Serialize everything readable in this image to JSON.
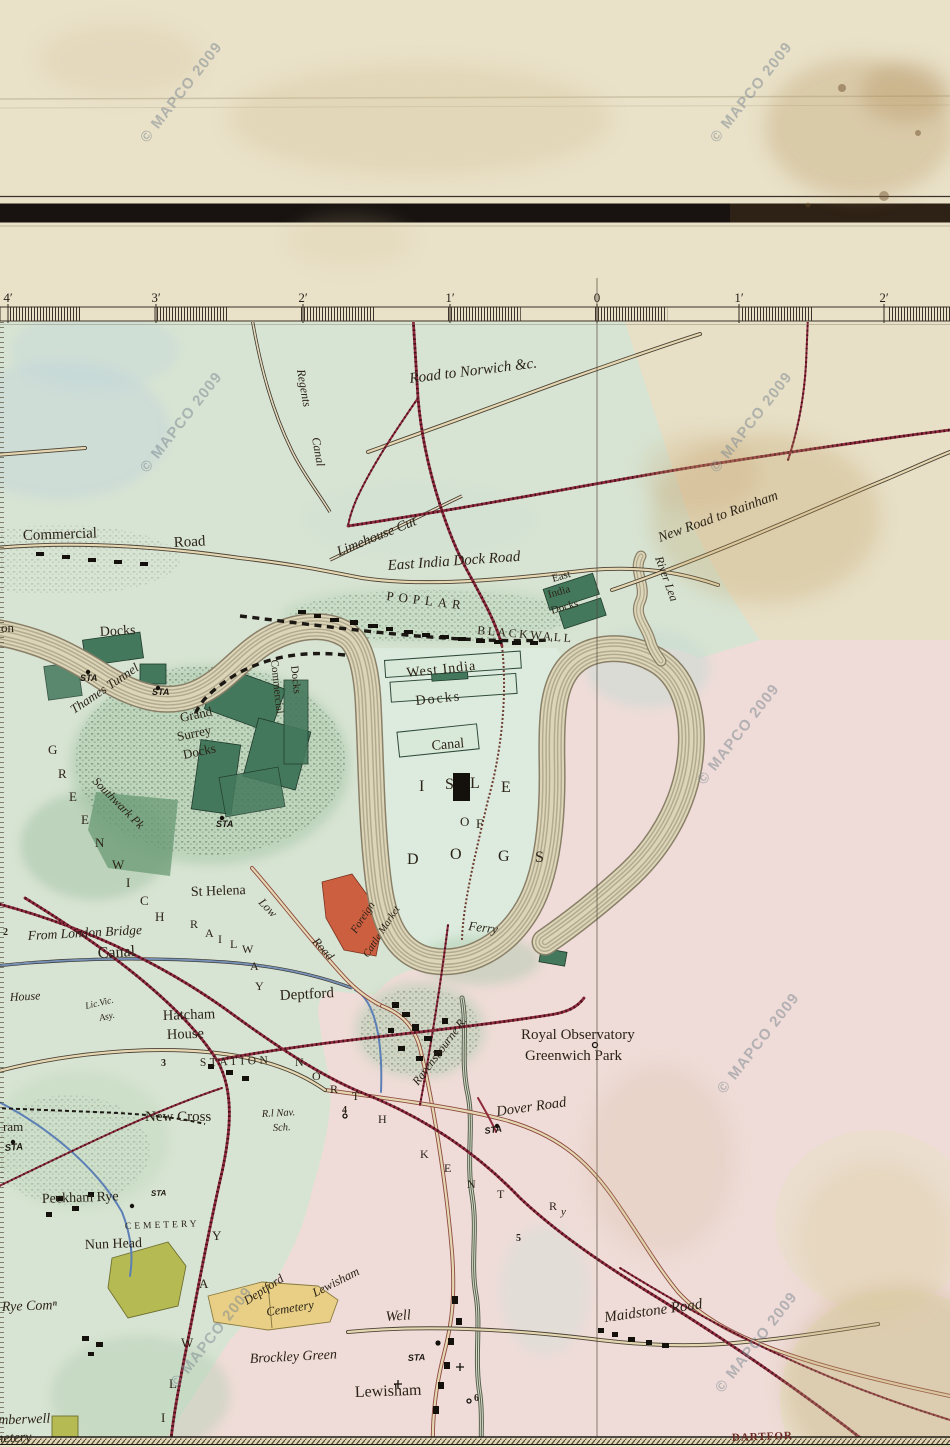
{
  "watermark": {
    "text": "© MAPCO 2009",
    "rotation": -52,
    "positions": [
      [
        185,
        95
      ],
      [
        755,
        95
      ],
      [
        185,
        425
      ],
      [
        755,
        425
      ],
      [
        742,
        737
      ],
      [
        762,
        1046
      ],
      [
        215,
        1340
      ],
      [
        760,
        1345
      ]
    ]
  },
  "scale_bar": {
    "unit_note": "miles",
    "ticks": [
      [
        "4′",
        8
      ],
      [
        "3′",
        156
      ],
      [
        "2′",
        303
      ],
      [
        "1′",
        450
      ],
      [
        "0",
        597
      ],
      [
        "1′",
        739
      ],
      [
        "2′",
        884
      ]
    ],
    "y_label": 302,
    "bar_top": 307,
    "bar_bottom": 321,
    "x_start": 8,
    "x_end": 950,
    "seg_px": 73.25
  },
  "meridian_x": 597,
  "colors": {
    "paper": "#e9e1c8",
    "map_green": "#d7e4d4",
    "map_pink": "#f0dcda",
    "map_cream": "#e7dfc6",
    "dock_green": "#44785c",
    "railway_red": "#8f2b3c",
    "road_tan": "#e4d7b2",
    "canal_blue": "#5c7fb5",
    "cemetery_yellow": "#e8cf85",
    "cemetery_green": "#b6ba52",
    "market_red": "#cd5f41",
    "ink": "#2b2317",
    "watermark_grey": "#7e8992",
    "river_band": "#b3ab90",
    "river_fill": "#ddd5b8",
    "border_black": "#181310"
  },
  "map": {
    "labels": [
      {
        "id": "road-to-norwich",
        "t": "Road to Norwich &c.",
        "x": 410,
        "y": 383,
        "r": -7,
        "s": 15,
        "c": "i"
      },
      {
        "id": "regents",
        "t": "Regents",
        "x": 297,
        "y": 370,
        "r": 80,
        "s": 12,
        "c": "i"
      },
      {
        "id": "regents-canal",
        "t": "Canal",
        "x": 312,
        "y": 438,
        "r": 80,
        "s": 12,
        "c": "i"
      },
      {
        "id": "commercial",
        "t": "Commercial",
        "x": 23,
        "y": 540,
        "r": -2,
        "s": 15
      },
      {
        "id": "commercial-road",
        "t": "Road",
        "x": 174,
        "y": 547,
        "r": -3,
        "s": 15
      },
      {
        "id": "limehouse-cut",
        "t": "Limehouse Cut",
        "x": 339,
        "y": 556,
        "r": -22,
        "s": 14,
        "c": "i"
      },
      {
        "id": "east-india-dock-road",
        "t": "East India Dock Road",
        "x": 388,
        "y": 570,
        "r": -4,
        "s": 15,
        "c": "i"
      },
      {
        "id": "poplar",
        "t": "POPLAR",
        "x": 386,
        "y": 600,
        "r": 7,
        "s": 13,
        "ls": 5
      },
      {
        "id": "blackwall",
        "t": "BLACKWALL",
        "x": 477,
        "y": 634,
        "r": 5,
        "s": 12,
        "ls": 2.5
      },
      {
        "id": "east-india-1",
        "t": "East",
        "x": 553,
        "y": 582,
        "r": -16,
        "s": 11
      },
      {
        "id": "east-india-2",
        "t": "India",
        "x": 549,
        "y": 598,
        "r": -16,
        "s": 11
      },
      {
        "id": "east-india-3",
        "t": "Docks",
        "x": 552,
        "y": 614,
        "r": -16,
        "s": 11
      },
      {
        "id": "new-road-rainham",
        "t": "New Road to Rainham",
        "x": 660,
        "y": 542,
        "r": -20,
        "s": 14,
        "c": "i"
      },
      {
        "id": "river-lea",
        "t": "River Lea",
        "x": 655,
        "y": 558,
        "r": 70,
        "s": 12,
        "c": "i"
      },
      {
        "id": "london-on",
        "t": "on",
        "x": 1,
        "y": 632,
        "s": 13
      },
      {
        "id": "london-docks",
        "t": "Docks",
        "x": 100,
        "y": 636,
        "r": -3,
        "s": 14
      },
      {
        "id": "thames-tunnel",
        "t": "Thames Tunnel",
        "x": 74,
        "y": 714,
        "r": -34,
        "s": 13,
        "c": "i"
      },
      {
        "id": "sta-1",
        "t": "STA",
        "x": 80,
        "y": 681,
        "s": 9,
        "c": "b"
      },
      {
        "id": "sta-2",
        "t": "STA",
        "x": 152,
        "y": 695,
        "s": 9,
        "c": "b"
      },
      {
        "id": "sta-3",
        "t": "STA",
        "x": 216,
        "y": 827,
        "s": 9,
        "c": "b"
      },
      {
        "id": "grand",
        "t": "Grand",
        "x": 181,
        "y": 722,
        "r": -12,
        "s": 13
      },
      {
        "id": "surrey",
        "t": "Surrey",
        "x": 178,
        "y": 741,
        "r": -12,
        "s": 13
      },
      {
        "id": "grand-surrey-docks",
        "t": "Docks",
        "x": 184,
        "y": 759,
        "r": -12,
        "s": 13
      },
      {
        "id": "commercial-docks-1",
        "t": "Commercial",
        "x": 271,
        "y": 660,
        "r": 84,
        "s": 11
      },
      {
        "id": "commercial-docks-2",
        "t": "Docks",
        "x": 291,
        "y": 666,
        "r": 84,
        "s": 11
      },
      {
        "id": "southwark-pk",
        "t": "Southwark Pk",
        "x": 92,
        "y": 782,
        "r": 45,
        "s": 12,
        "c": "i"
      },
      {
        "id": "west-india",
        "t": "West India",
        "x": 407,
        "y": 677,
        "r": -6,
        "s": 14,
        "ls": 1
      },
      {
        "id": "west-india-docks",
        "t": "Docks",
        "x": 416,
        "y": 705,
        "r": -6,
        "s": 14,
        "ls": 2
      },
      {
        "id": "millwall-canal",
        "t": "Canal",
        "x": 432,
        "y": 750,
        "r": -5,
        "s": 14
      },
      {
        "id": "isle-i",
        "t": "I",
        "x": 419,
        "y": 791,
        "s": 16
      },
      {
        "id": "isle-s",
        "t": "S",
        "x": 445,
        "y": 789,
        "s": 16
      },
      {
        "id": "isle-l",
        "t": "L",
        "x": 470,
        "y": 788,
        "s": 16
      },
      {
        "id": "isle-e",
        "t": "E",
        "x": 501,
        "y": 792,
        "s": 16
      },
      {
        "id": "isle-o2",
        "t": "O",
        "x": 460,
        "y": 826,
        "s": 13
      },
      {
        "id": "isle-f",
        "t": "F",
        "x": 476,
        "y": 828,
        "s": 13
      },
      {
        "id": "dogs-d",
        "t": "D",
        "x": 407,
        "y": 864,
        "s": 16
      },
      {
        "id": "dogs-o",
        "t": "O",
        "x": 450,
        "y": 859,
        "s": 16
      },
      {
        "id": "dogs-g",
        "t": "G",
        "x": 498,
        "y": 861,
        "s": 16
      },
      {
        "id": "dogs-s",
        "t": "S",
        "x": 535,
        "y": 862,
        "s": 16
      },
      {
        "id": "ferry",
        "t": "Ferry",
        "x": 468,
        "y": 930,
        "r": 7,
        "s": 13,
        "c": "i"
      },
      {
        "id": "foreign",
        "t": "Foreign",
        "x": 356,
        "y": 934,
        "r": -57,
        "s": 11,
        "c": "i"
      },
      {
        "id": "cattle-market",
        "t": "Cattle Market",
        "x": 368,
        "y": 958,
        "r": -57,
        "s": 10.5,
        "c": "i"
      },
      {
        "id": "st-helena",
        "t": "St Helena",
        "x": 191,
        "y": 896,
        "r": -2,
        "s": 14
      },
      {
        "id": "low",
        "t": "Low",
        "x": 258,
        "y": 903,
        "r": 46,
        "s": 12,
        "c": "i"
      },
      {
        "id": "low-road",
        "t": "Road",
        "x": 312,
        "y": 942,
        "r": 48,
        "s": 12,
        "c": "i"
      },
      {
        "id": "from-london-bridge",
        "t": "From London Bridge",
        "x": 28,
        "y": 940,
        "r": -3,
        "s": 13.5,
        "c": "i"
      },
      {
        "id": "surrey-canal",
        "t": "Canal",
        "x": 98,
        "y": 958,
        "r": -3,
        "s": 16
      },
      {
        "id": "mile-2",
        "t": "2",
        "x": 3,
        "y": 935,
        "s": 10,
        "c": "n"
      },
      {
        "id": "house-w",
        "t": "House",
        "x": 10,
        "y": 1001,
        "r": -3,
        "s": 12,
        "c": "i"
      },
      {
        "id": "lic-vic",
        "t": "Lic.Vic.",
        "x": 86,
        "y": 1009,
        "r": -13,
        "s": 9.5,
        "c": "i"
      },
      {
        "id": "asy",
        "t": "Asy.",
        "x": 100,
        "y": 1021,
        "r": -13,
        "s": 9.5,
        "c": "i"
      },
      {
        "id": "hatcham",
        "t": "Hatcham",
        "x": 163,
        "y": 1020,
        "r": -2,
        "s": 14.5
      },
      {
        "id": "hatcham-house",
        "t": "House",
        "x": 167,
        "y": 1039,
        "r": -2,
        "s": 14.5
      },
      {
        "id": "mile-3",
        "t": "3",
        "x": 161,
        "y": 1066,
        "s": 10,
        "c": "n"
      },
      {
        "id": "station",
        "t": "STATION",
        "x": 200,
        "y": 1066,
        "r": -2,
        "s": 11.5,
        "ls": 3.5
      },
      {
        "id": "deptford",
        "t": "Deptford",
        "x": 280,
        "y": 1000,
        "r": -3,
        "s": 15
      },
      {
        "id": "new-cross",
        "t": "New Cross",
        "x": 145,
        "y": 1121,
        "s": 15
      },
      {
        "id": "r-nav",
        "t": "R.l Nav.",
        "x": 262,
        "y": 1117,
        "r": -3,
        "s": 10.5,
        "c": "i"
      },
      {
        "id": "sch",
        "t": "Sch.",
        "x": 273,
        "y": 1131,
        "r": -3,
        "s": 10.5,
        "c": "i"
      },
      {
        "id": "mile-4",
        "t": "4",
        "x": 342,
        "y": 1113,
        "s": 10,
        "c": "n"
      },
      {
        "id": "dover-road",
        "t": "Dover Road",
        "x": 497,
        "y": 1116,
        "r": -8,
        "s": 14.5,
        "c": "i"
      },
      {
        "id": "sta-dover",
        "t": "STA",
        "x": 485,
        "y": 1134,
        "r": -8,
        "s": 9,
        "c": "b"
      },
      {
        "id": "royal-observatory",
        "t": "Royal Observatory",
        "x": 521,
        "y": 1039,
        "s": 15
      },
      {
        "id": "greenwich-park",
        "t": "Greenwich Park",
        "x": 525,
        "y": 1060,
        "s": 15
      },
      {
        "id": "ravensbourne",
        "t": "Ravensbourne R.",
        "x": 418,
        "y": 1086,
        "r": -53,
        "s": 12,
        "c": "i"
      },
      {
        "id": "peckham-rye",
        "t": "Peckham Rye",
        "x": 42,
        "y": 1203,
        "r": -2,
        "s": 14
      },
      {
        "id": "sta-peckham",
        "t": "STA",
        "x": 151,
        "y": 1196,
        "r": -2,
        "s": 8,
        "c": "b"
      },
      {
        "id": "cemetery-nunhead",
        "t": "CEMETERY",
        "x": 125,
        "y": 1229,
        "r": -2,
        "s": 9.5,
        "ls": 3
      },
      {
        "id": "nun-head",
        "t": "Nun Head",
        "x": 85,
        "y": 1249,
        "r": -2,
        "s": 14
      },
      {
        "id": "rye-common",
        "t": "Rye Comⁿ",
        "x": 2,
        "y": 1311,
        "r": -2,
        "s": 14,
        "c": "i"
      },
      {
        "id": "deptford-cem",
        "t": "Deptford",
        "x": 247,
        "y": 1305,
        "r": -33,
        "s": 12.5,
        "c": "i"
      },
      {
        "id": "lewisham-cem",
        "t": "Lewisham",
        "x": 315,
        "y": 1297,
        "r": -27,
        "s": 12.5,
        "c": "i"
      },
      {
        "id": "cemetery-word",
        "t": "Cemetery",
        "x": 267,
        "y": 1316,
        "r": -9,
        "s": 12.5,
        "c": "i"
      },
      {
        "id": "well",
        "t": "Well",
        "x": 386,
        "y": 1321,
        "r": -4,
        "s": 14.5,
        "c": "i"
      },
      {
        "id": "brockley-green",
        "t": "Brockley Green",
        "x": 250,
        "y": 1363,
        "r": -3,
        "s": 14,
        "c": "i"
      },
      {
        "id": "sta-well",
        "t": "STA",
        "x": 408,
        "y": 1361,
        "r": -3,
        "s": 9,
        "c": "b"
      },
      {
        "id": "lewisham",
        "t": "Lewisham",
        "x": 355,
        "y": 1397,
        "r": -2,
        "s": 16
      },
      {
        "id": "mile-6",
        "t": "6",
        "x": 474,
        "y": 1401,
        "s": 10,
        "c": "n"
      },
      {
        "id": "mile-5",
        "t": "5",
        "x": 516,
        "y": 1241,
        "s": 10,
        "c": "n"
      },
      {
        "id": "maidstone-road",
        "t": "Maidstone Road",
        "x": 605,
        "y": 1322,
        "r": -8,
        "s": 15,
        "c": "i"
      },
      {
        "id": "dartford",
        "t": "DARTFOR",
        "x": 732,
        "y": 1441,
        "r": -2,
        "s": 11,
        "c": "dart",
        "ls": 1
      },
      {
        "id": "camberwell",
        "t": "Camberwell",
        "x": -18,
        "y": 1425,
        "r": -2,
        "s": 14,
        "c": "i"
      },
      {
        "id": "camberwell-cemetery",
        "t": "Cemetery",
        "x": -22,
        "y": 1443,
        "r": -2,
        "s": 14,
        "c": "i"
      },
      {
        "id": "ram",
        "t": "ram",
        "x": 3,
        "y": 1131,
        "s": 13
      },
      {
        "id": "sta-left",
        "t": "STA",
        "x": 5,
        "y": 1151,
        "r": -5,
        "s": 9.5,
        "c": "b"
      },
      {
        "id": "grw-g",
        "t": "G",
        "x": 48,
        "y": 754,
        "s": 13
      },
      {
        "id": "grw-r",
        "t": "R",
        "x": 58,
        "y": 778,
        "s": 13
      },
      {
        "id": "grw-e1",
        "t": "E",
        "x": 69,
        "y": 801,
        "s": 13
      },
      {
        "id": "grw-e2",
        "t": "E",
        "x": 81,
        "y": 824,
        "s": 13
      },
      {
        "id": "grw-n",
        "t": "N",
        "x": 95,
        "y": 847,
        "s": 13
      },
      {
        "id": "grw-w",
        "t": "W",
        "x": 112,
        "y": 869,
        "s": 13
      },
      {
        "id": "grw-i",
        "t": "I",
        "x": 126,
        "y": 887,
        "s": 13
      },
      {
        "id": "grw-c",
        "t": "C",
        "x": 140,
        "y": 905,
        "s": 13
      },
      {
        "id": "grw-h",
        "t": "H",
        "x": 155,
        "y": 921,
        "s": 13
      },
      {
        "id": "rly1-r",
        "t": "R",
        "x": 190,
        "y": 928,
        "s": 12
      },
      {
        "id": "rly1-a1",
        "t": "A",
        "x": 205,
        "y": 937,
        "s": 12
      },
      {
        "id": "rly1-i",
        "t": "I",
        "x": 218,
        "y": 943,
        "s": 12
      },
      {
        "id": "rly1-l",
        "t": "L",
        "x": 230,
        "y": 948,
        "s": 12
      },
      {
        "id": "rly1-w",
        "t": "W",
        "x": 242,
        "y": 953,
        "s": 12
      },
      {
        "id": "rly1-a2",
        "t": "A",
        "x": 250,
        "y": 970,
        "s": 12
      },
      {
        "id": "rly1-y",
        "t": "Y",
        "x": 255,
        "y": 990,
        "s": 12
      },
      {
        "id": "rly2-y",
        "t": "Y",
        "x": 212,
        "y": 1240,
        "s": 13
      },
      {
        "id": "rly2-a",
        "t": "A",
        "x": 199,
        "y": 1288,
        "s": 13
      },
      {
        "id": "rly2-w",
        "t": "W",
        "x": 181,
        "y": 1347,
        "s": 13
      },
      {
        "id": "rly2-l",
        "t": "L",
        "x": 169,
        "y": 1388,
        "s": 13
      },
      {
        "id": "rly2-i",
        "t": "I",
        "x": 161,
        "y": 1422,
        "s": 13
      },
      {
        "id": "nk-n1",
        "t": "N",
        "x": 295,
        "y": 1066,
        "s": 12
      },
      {
        "id": "nk-o",
        "t": "O",
        "x": 312,
        "y": 1080,
        "s": 12
      },
      {
        "id": "nk-r",
        "t": "R",
        "x": 330,
        "y": 1093,
        "s": 12
      },
      {
        "id": "nk-t1",
        "t": "T",
        "x": 352,
        "y": 1100,
        "s": 12
      },
      {
        "id": "nk-h",
        "t": "H",
        "x": 378,
        "y": 1123,
        "s": 12
      },
      {
        "id": "nk-k",
        "t": "K",
        "x": 420,
        "y": 1158,
        "s": 12
      },
      {
        "id": "nk-e",
        "t": "E",
        "x": 444,
        "y": 1172,
        "s": 12
      },
      {
        "id": "nk-n2",
        "t": "N",
        "x": 467,
        "y": 1188,
        "s": 12
      },
      {
        "id": "nk-t2",
        "t": "T",
        "x": 497,
        "y": 1198,
        "s": 12
      },
      {
        "id": "nk-ry-r",
        "t": "R",
        "x": 549,
        "y": 1210,
        "s": 12
      },
      {
        "id": "nk-ry-y",
        "t": "y",
        "x": 561,
        "y": 1215,
        "s": 11,
        "c": "i"
      }
    ]
  }
}
